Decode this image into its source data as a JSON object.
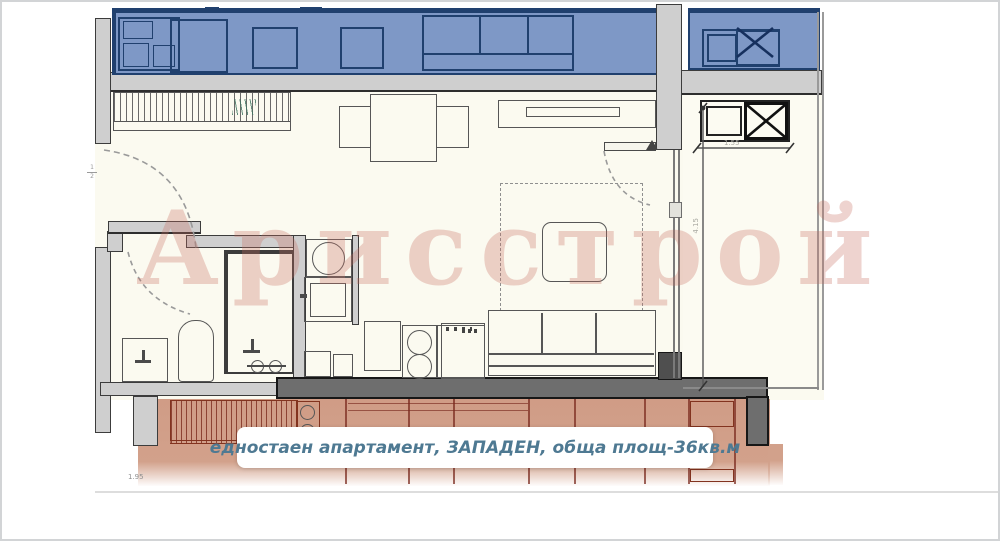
{
  "plan": {
    "watermark": "Арисстрой",
    "caption": "едностаен апартамент, ЗАПАДЕН, обща площ-36кв.м",
    "dimension_labels": {
      "terrace_width": "1.55",
      "terrace_depth": "4.15",
      "bottom_left": "1.95",
      "door_mark_top": "1",
      "door_mark_bottom": "2"
    },
    "colors": {
      "upper_neighbor_fill": "#7e98c6",
      "upper_neighbor_line": "#20406e",
      "lower_neighbor_fill": "#d2a18b",
      "lower_neighbor_line": "#82331f",
      "wall_light": "#cfcfcf",
      "wall_dark": "#6e6e6e",
      "interior_fill": "#fbfaf0",
      "caption_color": "#4e7992",
      "watermark_color": "rgba(200,110,95,0.30)"
    }
  }
}
